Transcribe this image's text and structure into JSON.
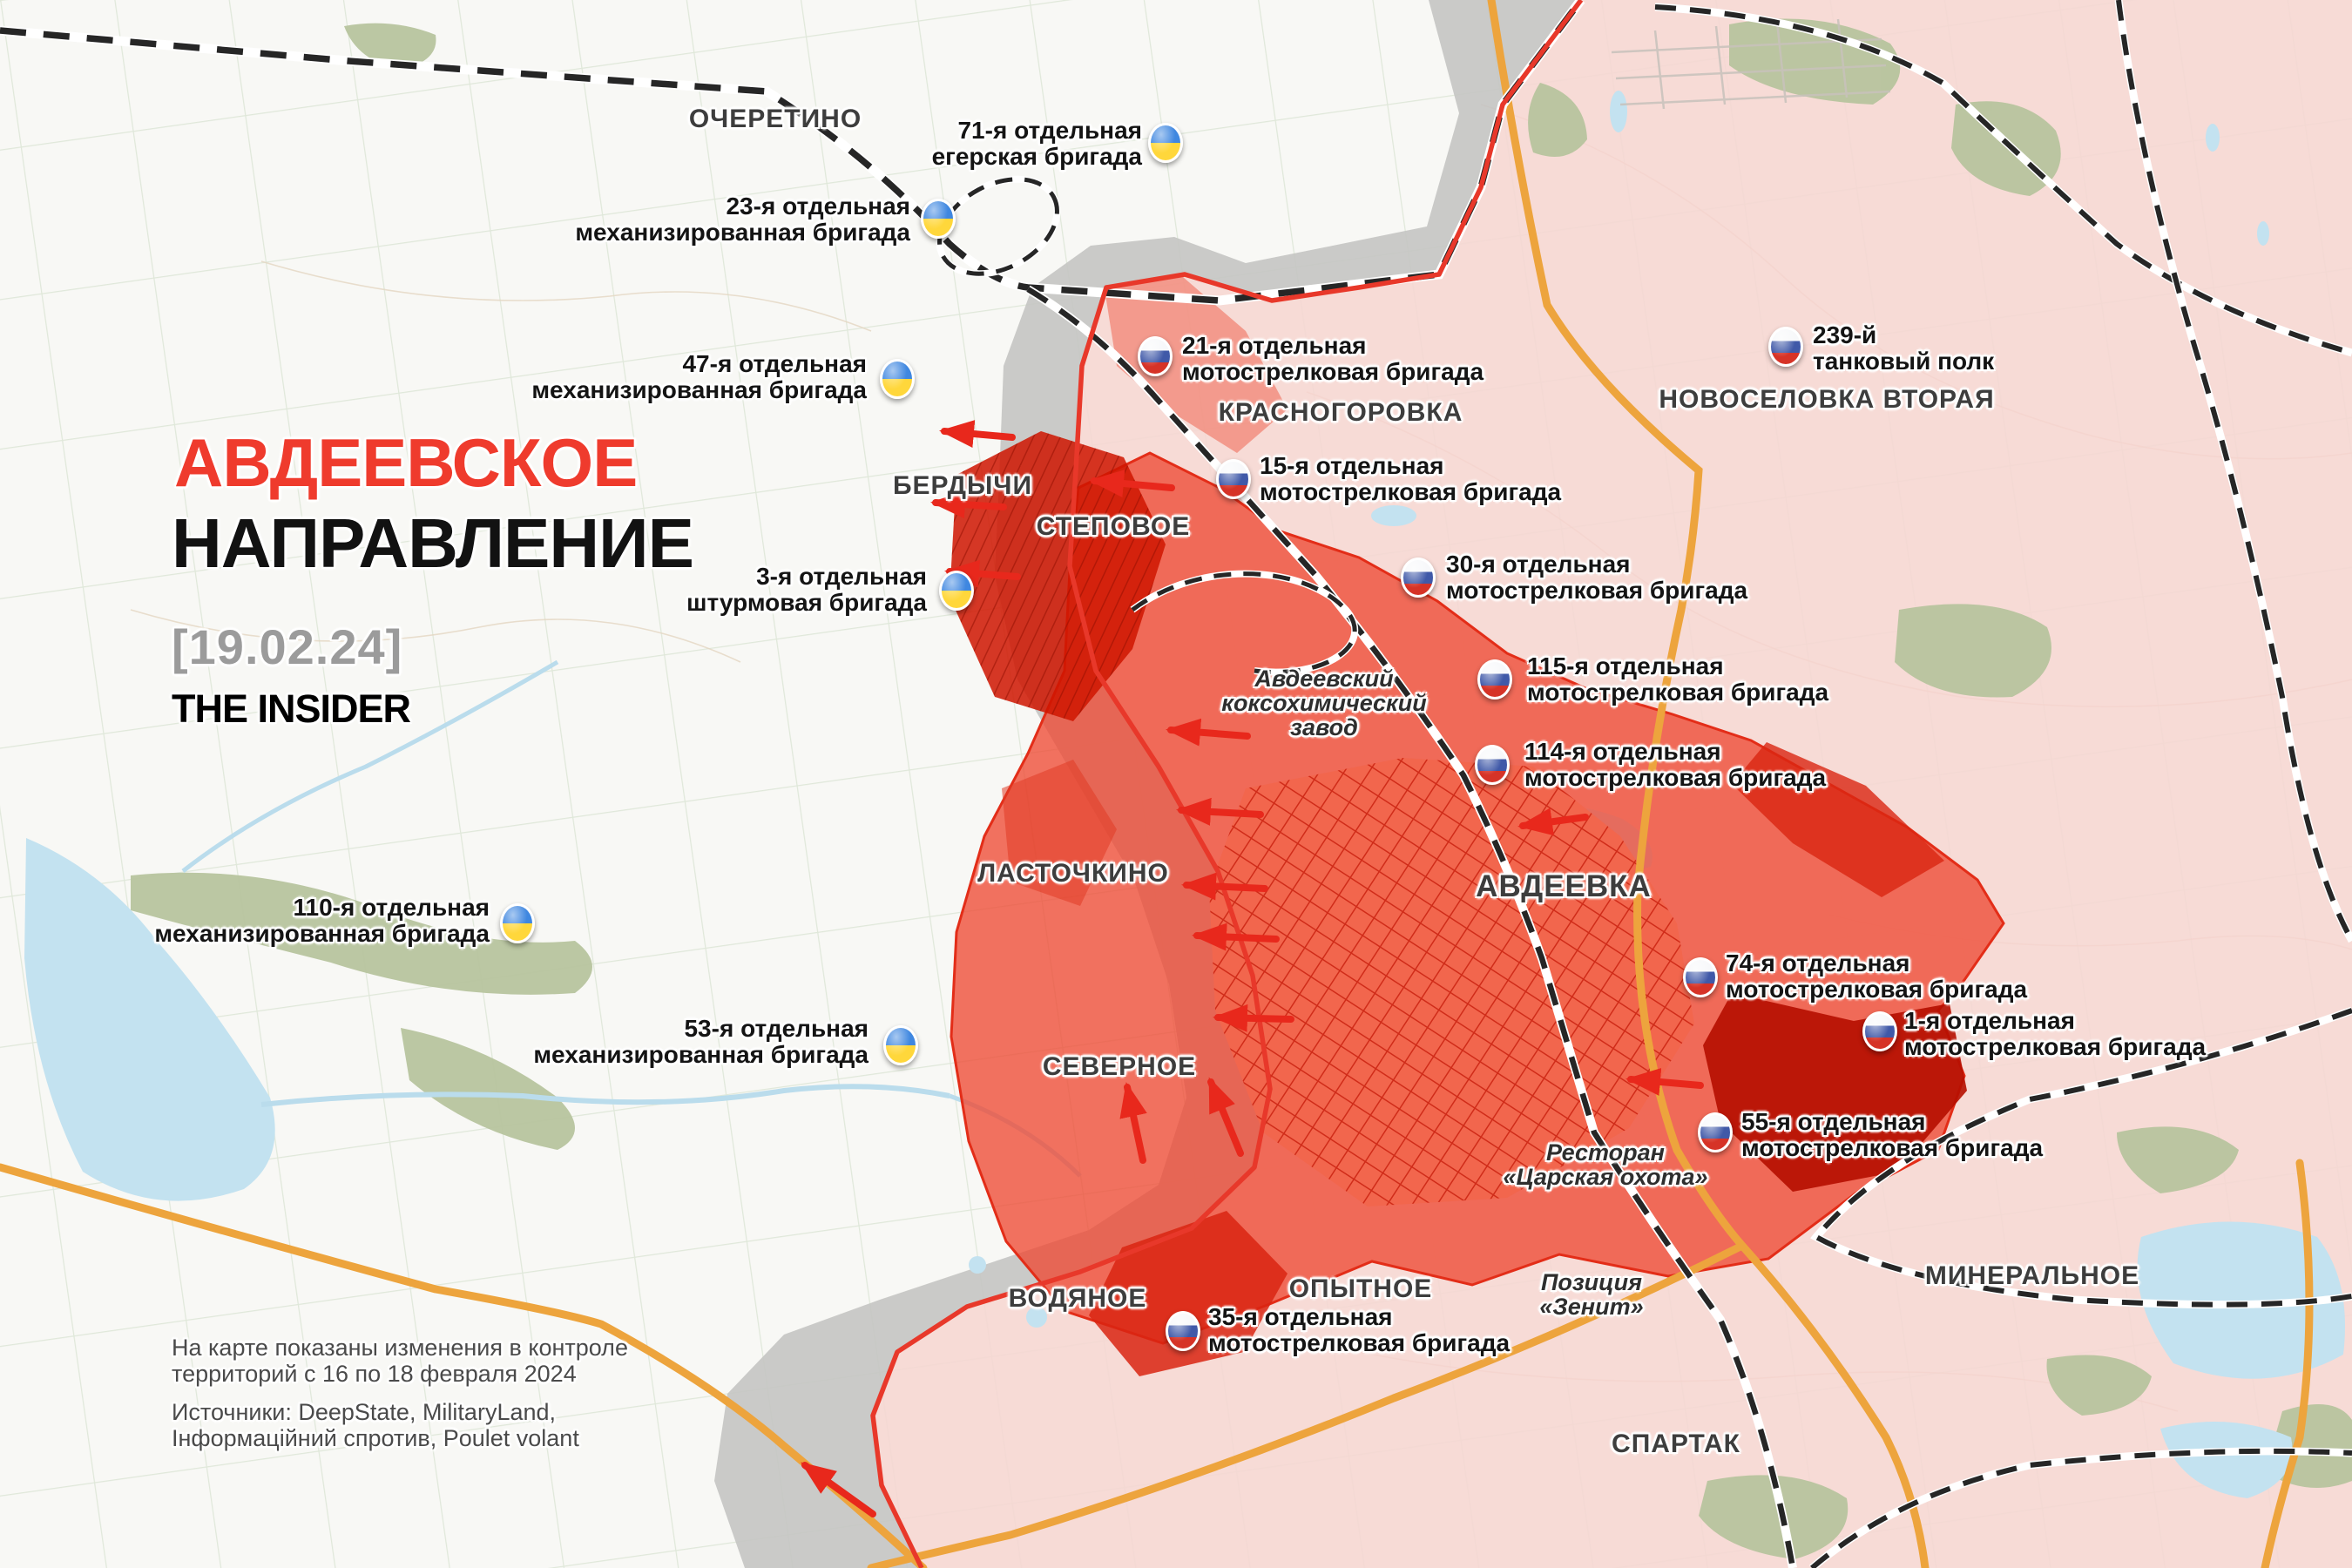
{
  "title": {
    "line1": "АВДЕЕВСКОЕ",
    "line2": "НАПРАВЛЕНИЕ",
    "date": "[19.02.24]",
    "brand": "THE INSIDER"
  },
  "footnote": {
    "l1a": "На карте показаны изменения в контроле",
    "l1b": "территорий с 16 по 18 февраля 2024",
    "l2a": "Источники: DeepState, MilitaryLand,",
    "l2b": "Інформаційний спротив, Poulet volant"
  },
  "cities": [
    {
      "id": "ocheretino",
      "name": "ОЧЕРЕТИНО"
    },
    {
      "id": "berdychi",
      "name": "БЕРДЫЧИ"
    },
    {
      "id": "stepovoe",
      "name": "СТЕПОВОЕ"
    },
    {
      "id": "krasnogorovka",
      "name": "КРАСНОГОРОВКА"
    },
    {
      "id": "novoselovka",
      "name": "НОВОСЕЛОВКА ВТОРАЯ"
    },
    {
      "id": "lastochkino",
      "name": "ЛАСТОЧКИНО"
    },
    {
      "id": "severnoe",
      "name": "СЕВЕРНОЕ"
    },
    {
      "id": "avdeevka",
      "name": "АВДЕЕВКА"
    },
    {
      "id": "vodyanoe",
      "name": "ВОДЯНОЕ"
    },
    {
      "id": "opytnoe",
      "name": "ОПЫТНОЕ"
    },
    {
      "id": "mineralnoe",
      "name": "МИНЕРАЛЬНОЕ"
    },
    {
      "id": "spartak",
      "name": "СПАРТАК"
    }
  ],
  "landmarks": [
    {
      "id": "koksokhim",
      "line1": "Авдеевский",
      "line2": "коксохимический",
      "line3": "завод"
    },
    {
      "id": "restoran",
      "line1": "Ресторан",
      "line2": "«Царская охота»"
    },
    {
      "id": "zenit",
      "line1": "Позиция",
      "line2": "«Зенит»"
    }
  ],
  "units": [
    {
      "country": "ua",
      "line1": "71-я отдельная",
      "line2": "егерская бригада"
    },
    {
      "country": "ua",
      "line1": "23-я отдельная",
      "line2": "механизированная бригада"
    },
    {
      "country": "ua",
      "line1": "47-я отдельная",
      "line2": "механизированная бригада"
    },
    {
      "country": "ua",
      "line1": "3-я отдельная",
      "line2": "штурмовая бригада"
    },
    {
      "country": "ua",
      "line1": "110-я отдельная",
      "line2": "механизированная бригада"
    },
    {
      "country": "ua",
      "line1": "53-я отдельная",
      "line2": "механизированная бригада"
    },
    {
      "country": "ru",
      "line1": "21-я отдельная",
      "line2": "мотострелковая бригада"
    },
    {
      "country": "ru",
      "line1": "15-я отдельная",
      "line2": "мотострелковая бригада"
    },
    {
      "country": "ru",
      "line1": "30-я отдельная",
      "line2": "мотострелковая бригада"
    },
    {
      "country": "ru",
      "line1": "239-й",
      "line2": "танковый полк"
    },
    {
      "country": "ru",
      "line1": "115-я отдельная",
      "line2": "мотострелковая бригада"
    },
    {
      "country": "ru",
      "line1": "114-я отдельная",
      "line2": "мотострелковая бригада"
    },
    {
      "country": "ru",
      "line1": "74-я отдельная",
      "line2": "мотострелковая бригада"
    },
    {
      "country": "ru",
      "line1": "1-я отдельная",
      "line2": "мотострелковая бригада"
    },
    {
      "country": "ru",
      "line1": "55-я отдельная",
      "line2": "мотострелковая бригада"
    },
    {
      "country": "ru",
      "line1": "35-я отдельная",
      "line2": "мотострелковая бригада"
    }
  ],
  "colors": {
    "accent_red_title": "#ef3b2d",
    "ua_pin_blue": "#3f87e0",
    "ua_pin_yellow": "#ffd73b",
    "ru_pin_blue": "#4059a8",
    "ru_pin_red": "#d63327",
    "ru_control_pink": "#f6d6d2",
    "advance_red": "#ee4a35",
    "contested_gray": "#c6c5c3",
    "front_line_red": "#e8382a",
    "road_orange": "#eda43d",
    "water_blue": "#c3e2f0",
    "forest_green": "#b7c49e"
  }
}
